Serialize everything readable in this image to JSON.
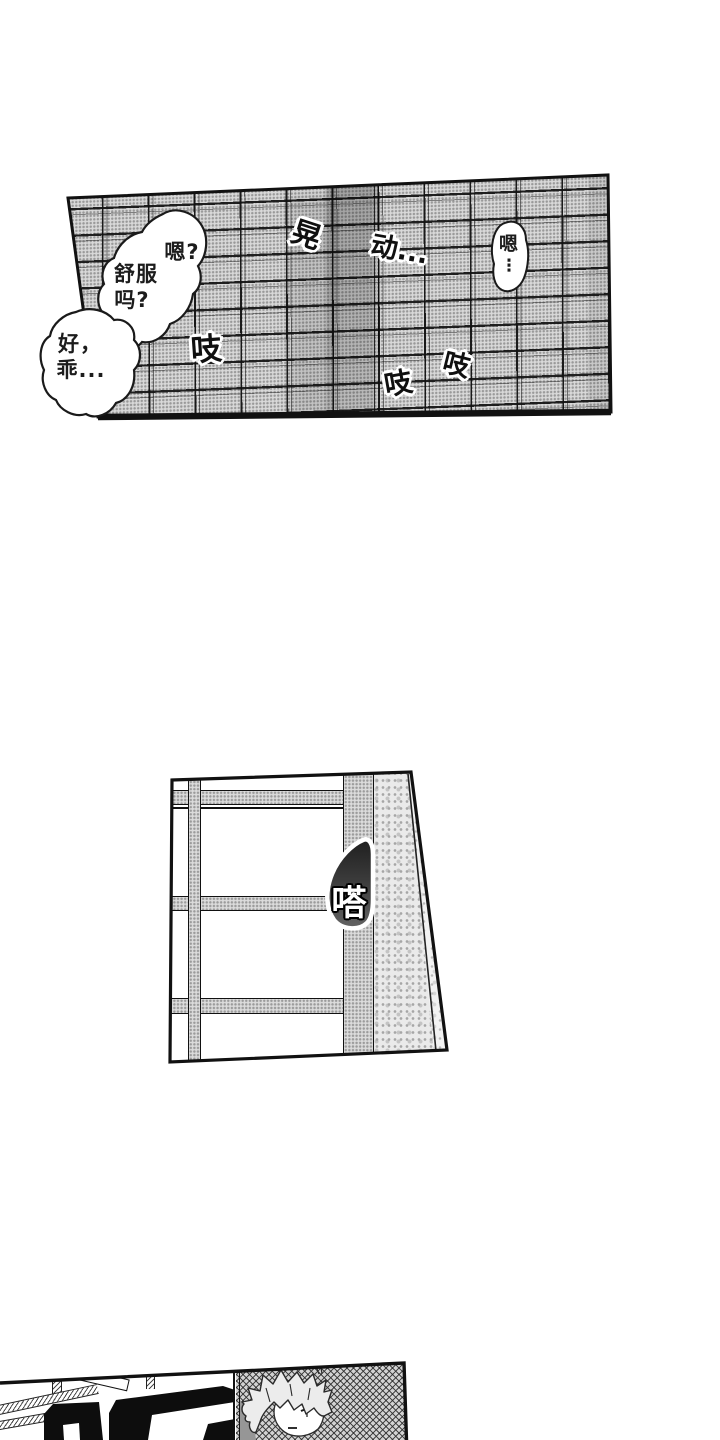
{
  "page": {
    "type": "manga-page",
    "colors": {
      "ink": "#111111",
      "paper": "#ffffff",
      "tone": "#d9d9d9",
      "blob_dark": "#1f1f1f",
      "blob_mid": "#5d5d5d"
    }
  },
  "panel_top": {
    "description": "tiled-sliding-door-panel",
    "bubble_main": {
      "line1": "嗯?",
      "line2": "舒服",
      "line3": "吗?"
    },
    "bubble_left": {
      "line1": "好，",
      "line2": "乖..."
    },
    "bubble_right": {
      "char": "嗯",
      "ellipsis": "⋮"
    },
    "sfx_huang": "晃",
    "sfx_dong": "动...",
    "sfx_zhi_1": "吱",
    "sfx_zhi_2": "吱",
    "sfx_zhi_3": "吱"
  },
  "panel_mid": {
    "description": "window-frame-panel",
    "sfx_ta": "嗒"
  },
  "panel_bottom": {
    "description": "doorway-character-panel",
    "sfx_large": "咚"
  }
}
